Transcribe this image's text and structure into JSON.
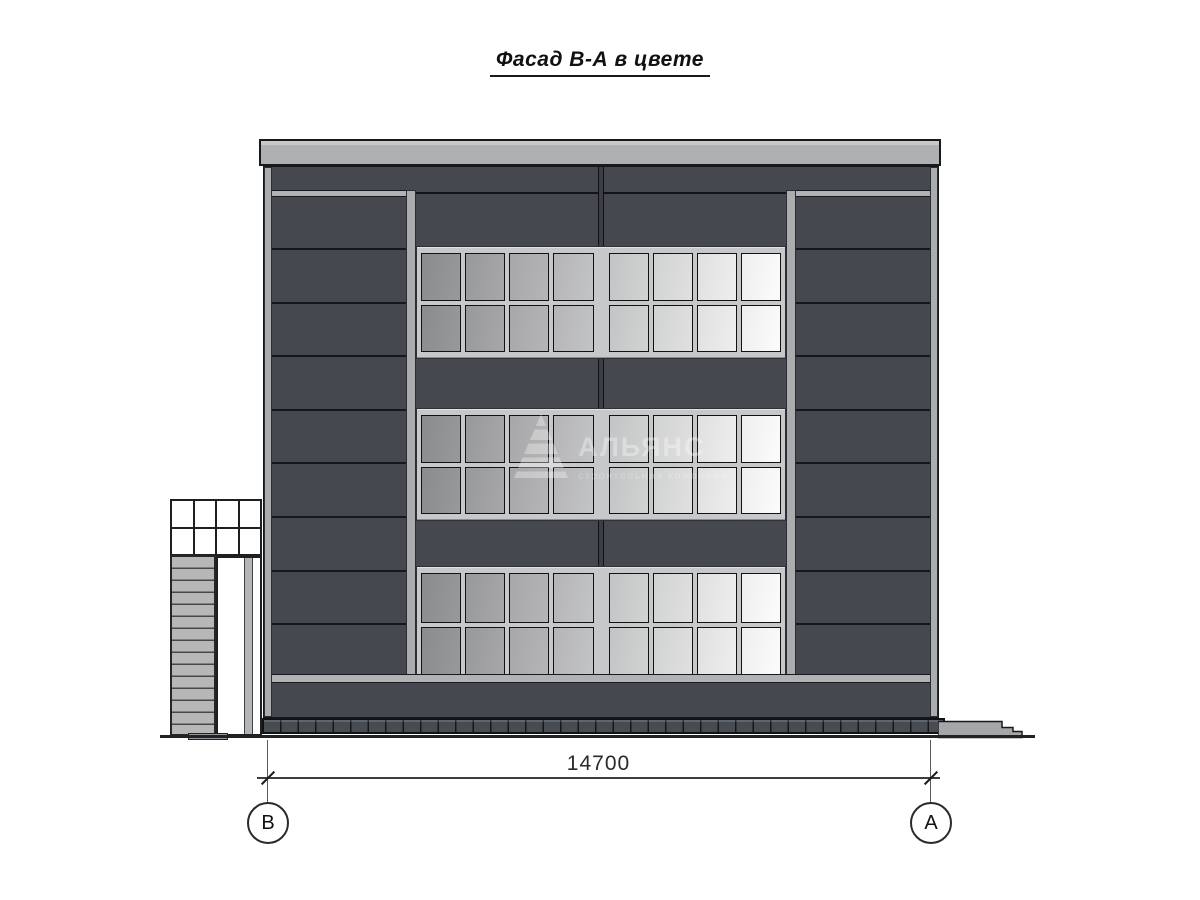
{
  "title": {
    "text": "Фасад В-А в цвете"
  },
  "dimension": {
    "value": "14700"
  },
  "axes": {
    "left_label": "В",
    "right_label": "А"
  },
  "watermark": {
    "name": "АЛЬЯНС",
    "subtitle": "строительная компания",
    "logo": "pyramid-a-logo"
  },
  "elevation": {
    "window_bands": 3,
    "panes_per_row": 8,
    "pane_rows_per_band": 2,
    "panel_seams_per_side_section": 8,
    "annex": {
      "glazing_cols": 4,
      "glazing_rows": 2,
      "stair_treads": 15
    },
    "plinth_blocks": 40
  },
  "colors": {
    "facade_panel": "#45494f",
    "panel_seam": "#15171a",
    "trim_light": "#aaacae",
    "parapet": "#b1b3b5",
    "window_frame": "#c6c8ca",
    "glass_dark": "#8a8b8d",
    "glass_light": "#fcfcfc",
    "annex_glazing": "#ffffff",
    "stair_tread": "#b7b7b7",
    "plinth": "#474b52",
    "ground_line": "#202225",
    "dimension_line": "#3c3e40"
  }
}
